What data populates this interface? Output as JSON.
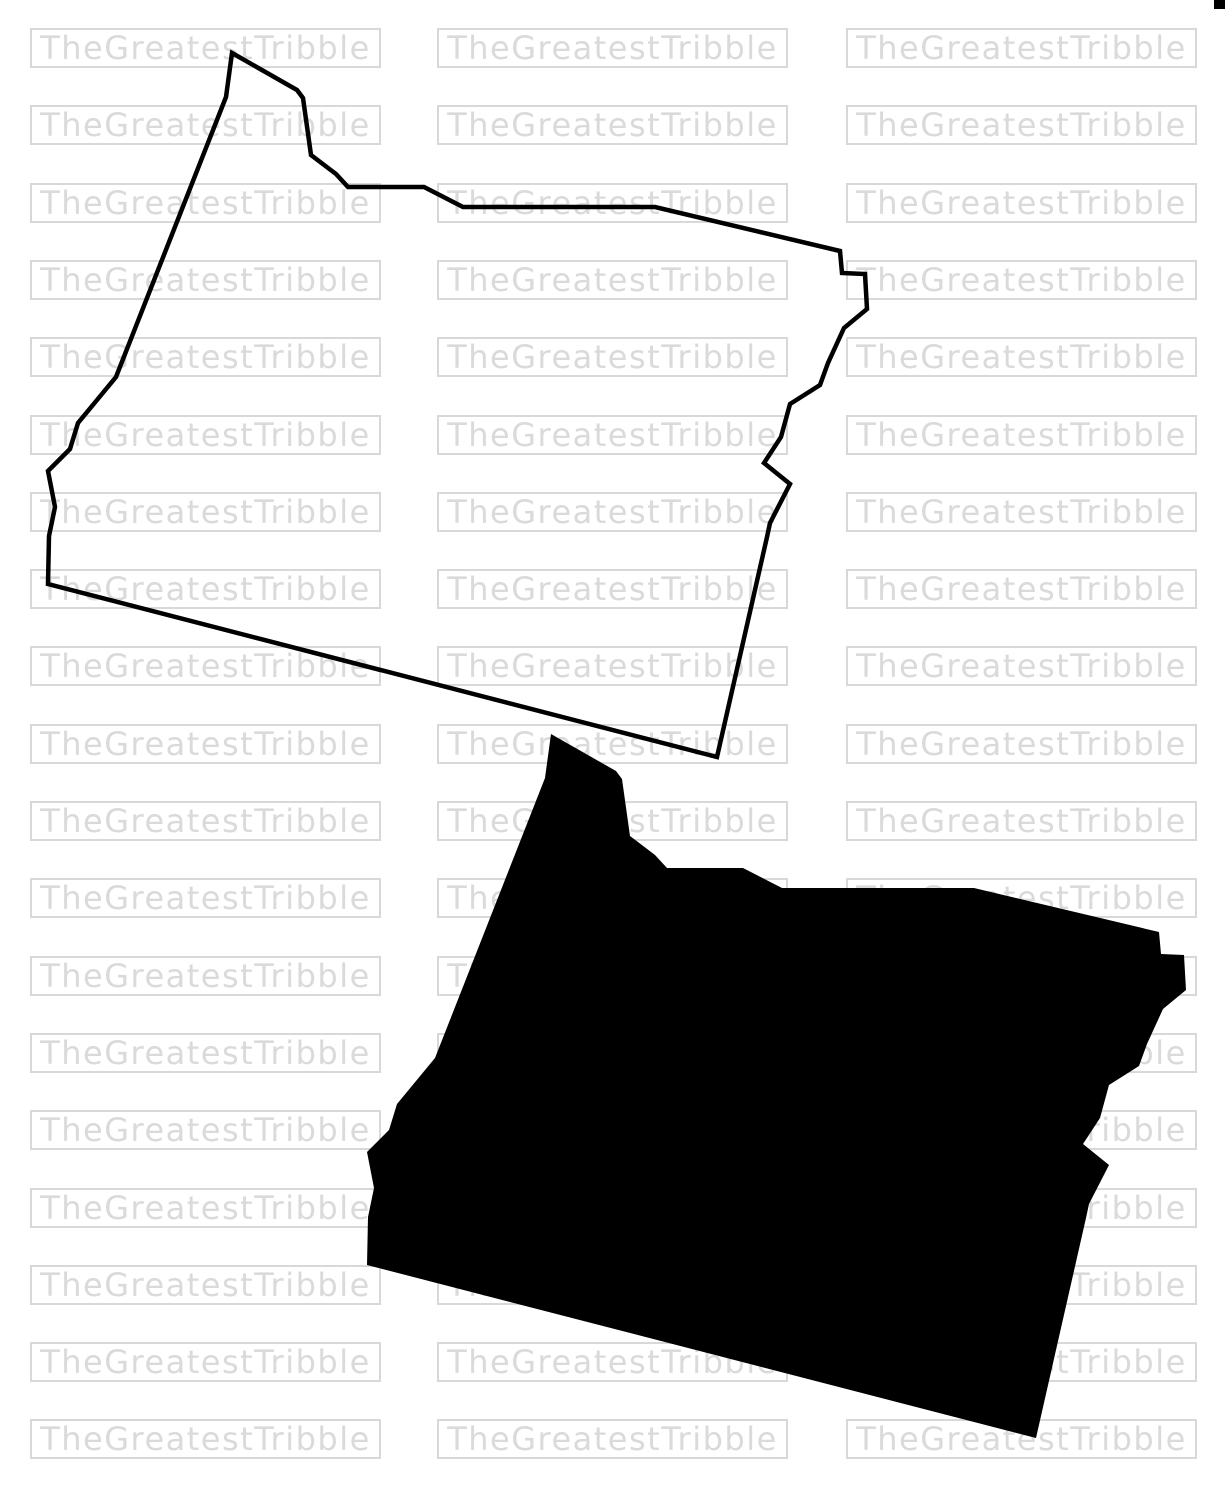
{
  "canvas": {
    "width": 1225,
    "height": 1500,
    "background": "#ffffff"
  },
  "watermark": {
    "label": "TheGreatestTribble",
    "text_color": "#dadada",
    "border_color": "#d8d8d8",
    "grid": {
      "column_lefts": [
        30,
        437,
        846
      ],
      "row_top_start": 28,
      "row_pitch": 77.3,
      "row_count": 19,
      "box_width": 351,
      "box_height": 40
    }
  },
  "artwork": {
    "shape_points": [
      [
        232,
        53
      ],
      [
        297,
        90
      ],
      [
        303,
        98
      ],
      [
        311,
        155
      ],
      [
        336,
        174
      ],
      [
        348,
        187
      ],
      [
        424,
        187
      ],
      [
        463,
        207
      ],
      [
        655,
        207
      ],
      [
        840,
        251
      ],
      [
        842,
        273
      ],
      [
        865,
        274
      ],
      [
        867,
        309
      ],
      [
        844,
        328
      ],
      [
        828,
        363
      ],
      [
        820,
        385
      ],
      [
        790,
        404
      ],
      [
        781,
        437
      ],
      [
        764,
        463
      ],
      [
        790,
        484
      ],
      [
        770,
        523
      ],
      [
        767,
        537
      ],
      [
        717,
        757
      ],
      [
        48,
        584
      ],
      [
        49,
        536
      ],
      [
        55,
        507
      ],
      [
        48,
        471
      ],
      [
        70,
        449
      ],
      [
        78,
        423
      ],
      [
        97,
        400
      ],
      [
        116,
        377
      ],
      [
        226,
        97
      ]
    ],
    "outline_style": {
      "stroke": "#000000",
      "stroke_width": 4.5,
      "fill": "none"
    },
    "outline_offset": [
      0,
      0
    ],
    "silhouette_style": {
      "fill": "#000000"
    },
    "silhouette_offset": [
      319,
      681
    ],
    "corner_mark": {
      "x": 1214,
      "y": 0,
      "width": 11,
      "height": 9,
      "fill": "#000000"
    }
  }
}
